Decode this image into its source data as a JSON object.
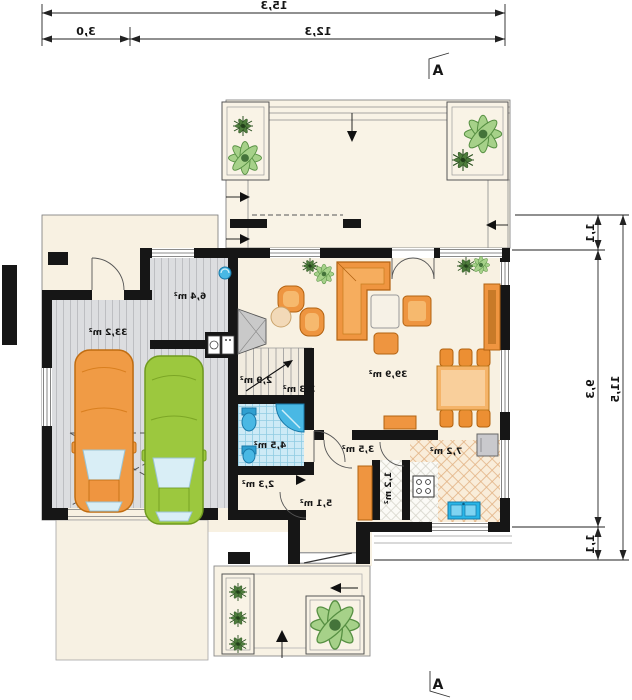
{
  "plan": {
    "type": "floor-plan-mirrored-blueprint",
    "dimensions_m": {
      "top_total": "15,3",
      "top_left": "3,0",
      "top_right": "12,3",
      "right_total": "11,5",
      "right_top": "1,1",
      "right_middle": "9,3",
      "right_bottom": "1,1"
    },
    "section_markers": {
      "top": "A",
      "bottom": "A"
    },
    "rooms": {
      "garage": {
        "name": "garage",
        "area": "33,2 m²"
      },
      "utility": {
        "name": "utility-room",
        "area": "6,4 m²"
      },
      "living": {
        "name": "living-dining-room",
        "area": "39,9 m²"
      },
      "corridor": {
        "name": "corridor",
        "area": "2,9 m²"
      },
      "stairs": {
        "name": "stairs",
        "area": "3,3 m²"
      },
      "bathroom": {
        "name": "bathroom",
        "area": "4,5 m²"
      },
      "closet": {
        "name": "closet",
        "area": "2,3 m²"
      },
      "hall": {
        "name": "entry-hall",
        "area": "5,1 m²"
      },
      "hallway": {
        "name": "hallway",
        "area": "3,5 m²"
      },
      "pantry": {
        "name": "pantry",
        "area": "1,2 m²"
      },
      "kitchen": {
        "name": "kitchen",
        "area": "7,2 m²"
      }
    },
    "icons": {
      "plant": "radial-leaf-cluster",
      "toilet": "tank-and-bowl",
      "shower": "quarter-circle-corner",
      "washbasin": "pedestal-basin",
      "stove": "four-burner-hob",
      "fridge": "gray-box",
      "kitchen-sink": "double-basin-blue",
      "washer": "drum-box",
      "fireplace": "hatched-trapezoid",
      "floor-drain": "blue-circle",
      "cars": [
        "orange-car-top-view",
        "green-car-top-view"
      ],
      "direction-arrows": "filled-black-triangles"
    },
    "colors": {
      "wall": "#161616",
      "floor_cream": "#f8f1e2",
      "terrace_cream": "#f9f3e6",
      "floor_gray_planks": "#dcdde0",
      "tile_blue": "#cdeaf6",
      "fixture_blue": "#49b8e4",
      "furniture_orange": "#ef9540",
      "car_orange": "#f09b45",
      "car_green": "#9cc83e",
      "plant_green": "#a6d189",
      "plant_dark": "#4e7d3c"
    }
  }
}
